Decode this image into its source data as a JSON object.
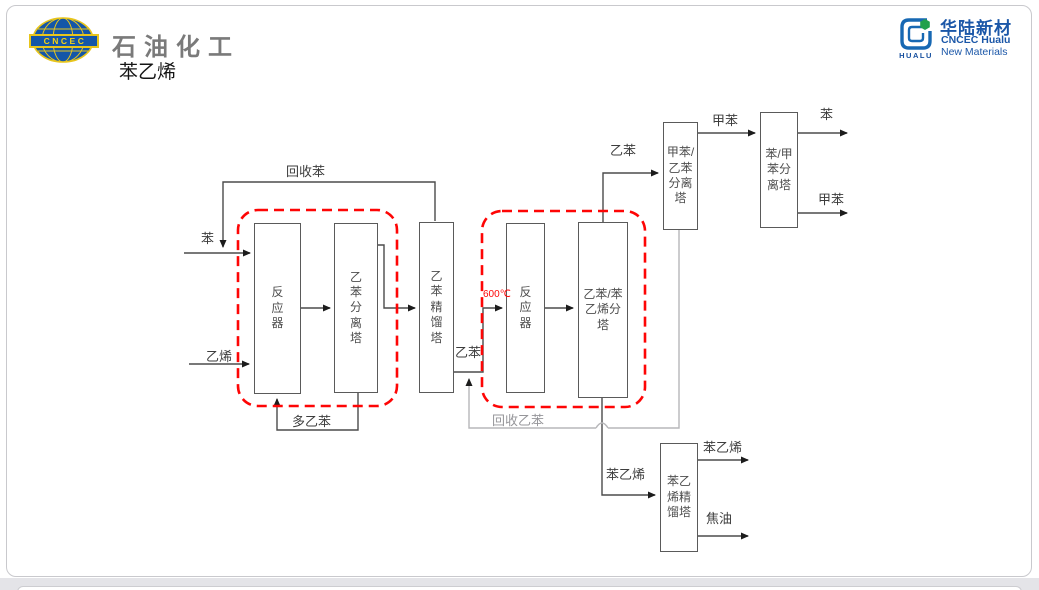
{
  "header": {
    "badge": "CNCEC",
    "brand": "石油化工",
    "subtitle": "苯乙烯",
    "right_logo": {
      "cn": "华陆新材",
      "en1": "CNCEC Hualu",
      "en2": "New Materials",
      "mark": "HUALU"
    }
  },
  "diagram": {
    "towers": {
      "reactor1": "反\n应\n器",
      "eb_sep": "乙\n苯\n分\n离\n塔",
      "eb_dist": "乙\n苯\n精\n馏\n塔",
      "reactor2": "反\n应\n器",
      "eb_sm_split": "乙苯/苯\n乙烯分\n塔",
      "tol_eb_sep": "甲苯/\n乙苯\n分离\n塔",
      "ben_tol_sep": "苯/甲\n苯分\n离塔",
      "sm_dist": "苯乙\n烯精\n馏塔"
    },
    "labels": {
      "benzene_in": "苯",
      "ethylene_in": "乙烯",
      "recycle_benzene": "回收苯",
      "poly_eb": "多乙苯",
      "eb_mid": "乙苯",
      "temperature": "600℃",
      "recycle_eb": "回收乙苯",
      "eb_top": "乙苯",
      "toluene_mid": "甲苯",
      "benzene_out": "苯",
      "toluene_out": "甲苯",
      "sm_mid": "苯乙烯",
      "sm_out": "苯乙烯",
      "tar_out": "焦油"
    },
    "colors": {
      "line": "#4b4b4b",
      "light_line": "#b7b7ba",
      "highlight_dash": "#fe0505",
      "box_border": "#5a5a5a"
    }
  }
}
